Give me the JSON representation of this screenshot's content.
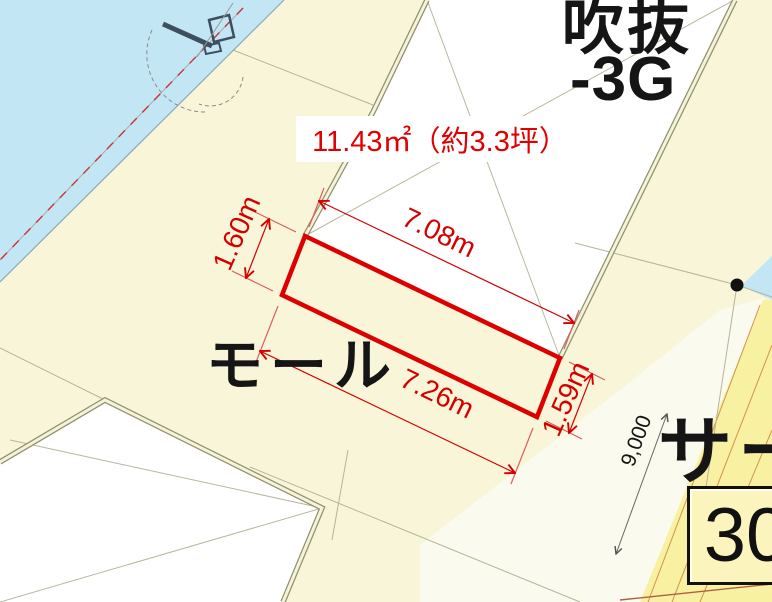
{
  "drawing": {
    "type": "site-floor-plan",
    "annotations": {
      "area_label": "11.43㎡（約3.3坪）",
      "void_label_line1": "吹抜",
      "void_label_line2": "-3G",
      "mall_label": "モール",
      "service_label": "サー",
      "span_label": "9,000",
      "parcel_number": "30"
    },
    "dimensions": {
      "top": "7.08m",
      "left": "1.60m",
      "bottom": "7.26m",
      "right": "1.59m"
    },
    "highlight_area": {
      "area_m2": "11.43",
      "area_tsubo": "3.3",
      "outline_color": "#dd0000"
    },
    "colors": {
      "background_cream": "#f9f5d8",
      "water_blue": "#c3e6f4",
      "road_yellow": "#f8f1a2",
      "void_white": "#ffffff",
      "light_band": "#fbfaef",
      "dimension_red": "#d40000",
      "wall_line": "#90906e",
      "text_black": "#151515"
    }
  }
}
